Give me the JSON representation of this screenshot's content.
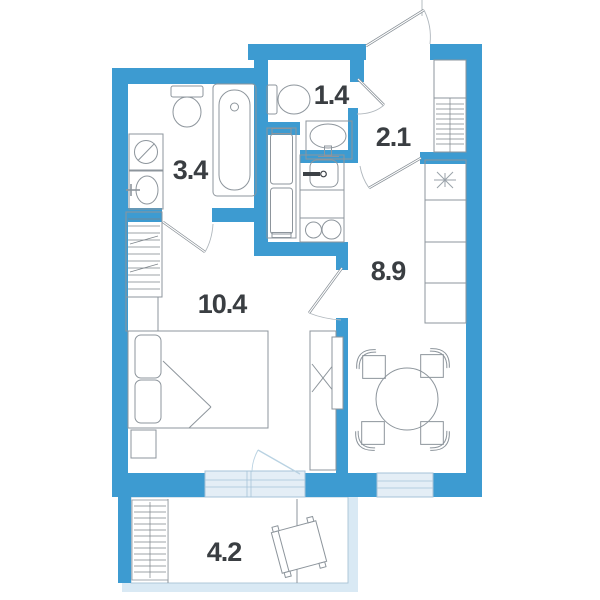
{
  "plan": {
    "type": "apartment-floor-plan",
    "rooms": [
      {
        "name": "bathroom",
        "label": "3.4"
      },
      {
        "name": "wc",
        "label": "1.4"
      },
      {
        "name": "hallway",
        "label": "2.1"
      },
      {
        "name": "kitchen-living-room",
        "label": "8.9"
      },
      {
        "name": "bedroom",
        "label": "10.4"
      },
      {
        "name": "balcony",
        "label": "4.2"
      }
    ],
    "colors": {
      "wall": "#3d9bd1",
      "window_fill": "#e4eef6",
      "window_frame": "#a6c3d8",
      "balcony_band": "#d9e9f4",
      "furniture_line": "#8d959c",
      "hatch_line": "#7d848a",
      "label_text": "#3a3e42",
      "door_line": "#858d94",
      "arc_line": "#b0b7bd",
      "balcony_door_line": "#b9d2e2",
      "dark_fixture": "#3c4146"
    }
  }
}
